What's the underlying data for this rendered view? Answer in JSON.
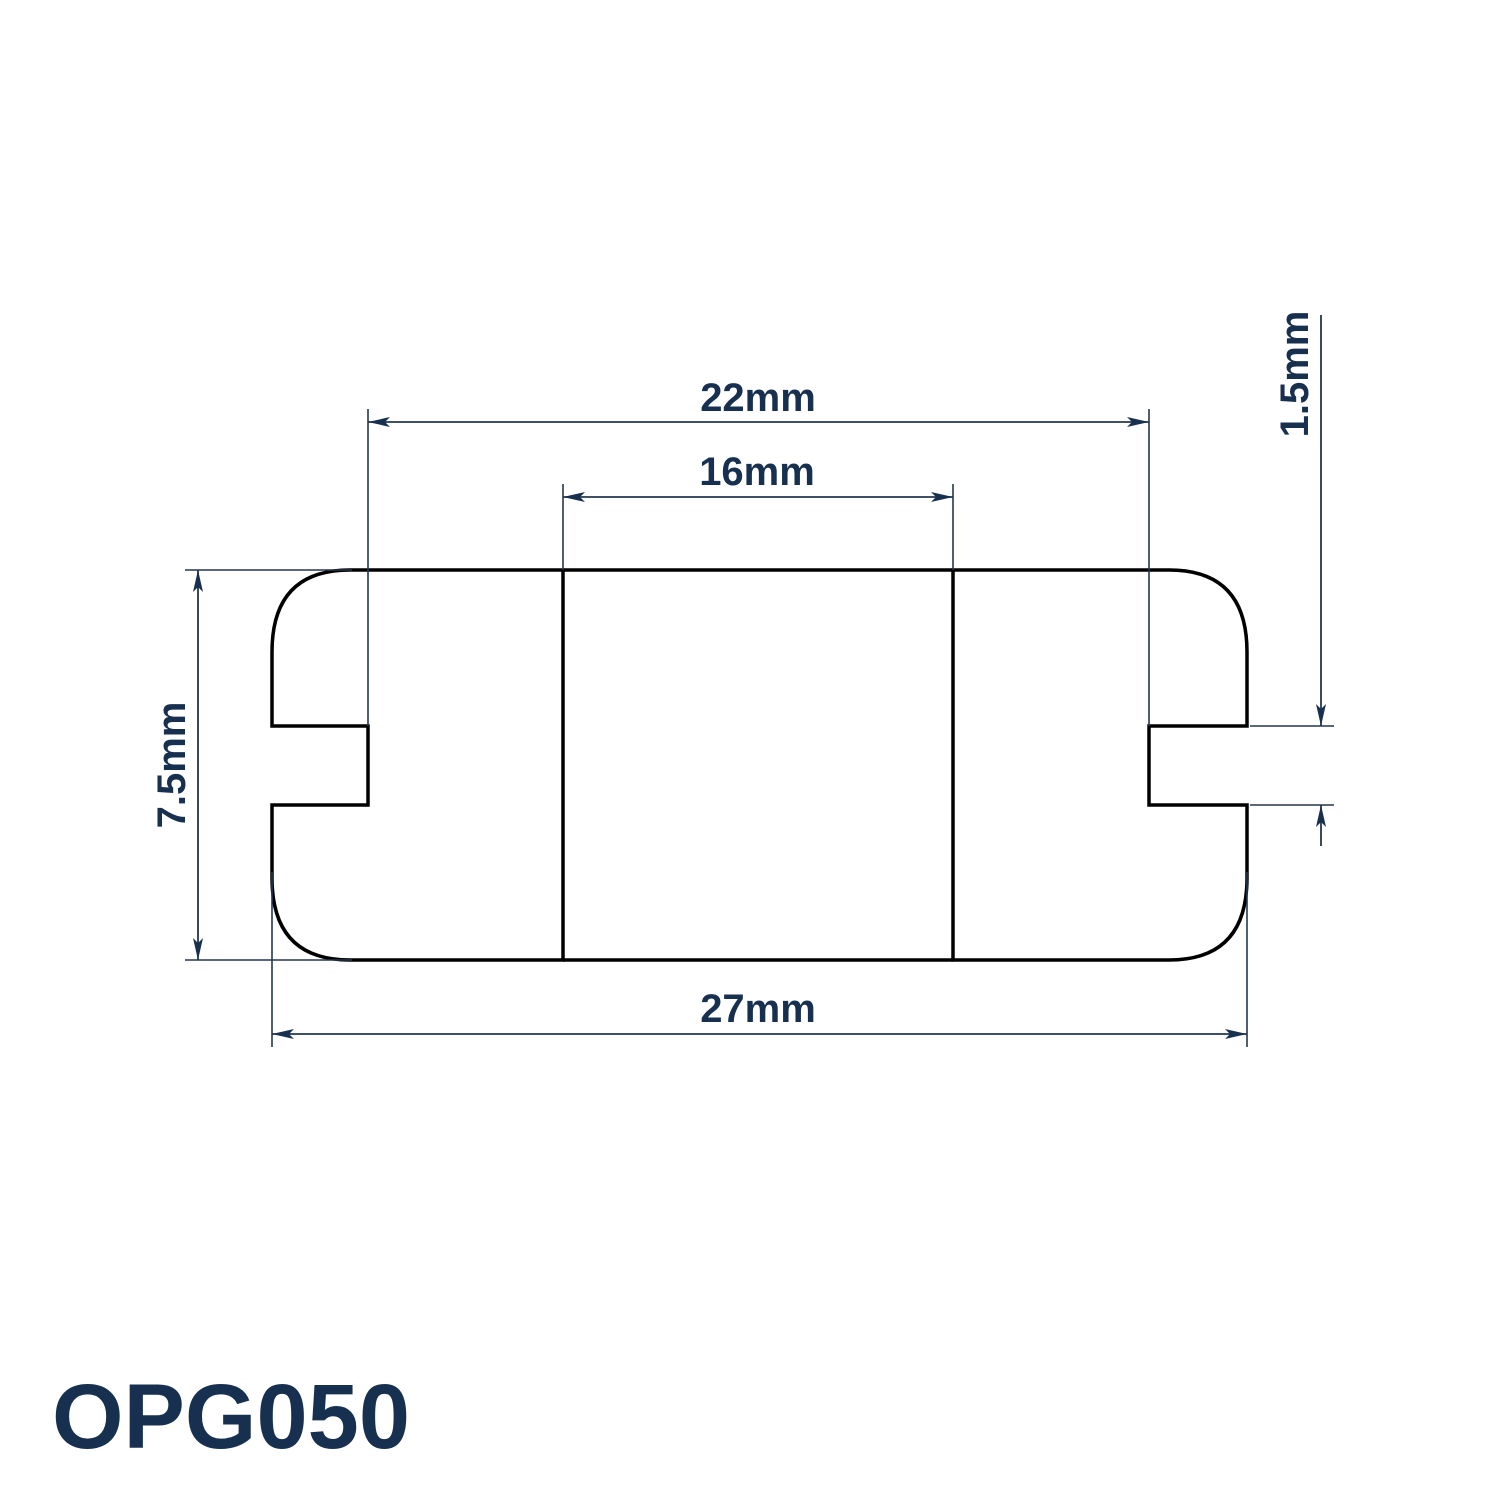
{
  "title": {
    "product_code": "OPG050"
  },
  "drawing": {
    "type": "technical-cross-section",
    "subject": "open-grommet-profile",
    "hatch_style": "diagonal-45deg",
    "dimensions": {
      "groove_diameter_label": "22mm",
      "inner_diameter_label": "16mm",
      "overall_diameter_label": "27mm",
      "overall_height_label": "7.5mm",
      "panel_thickness_label": "1.5mm"
    }
  },
  "colors": {
    "background": "#ffffff",
    "outline": "#000000",
    "dimension_line": "#24374f",
    "text": "#18304f"
  }
}
